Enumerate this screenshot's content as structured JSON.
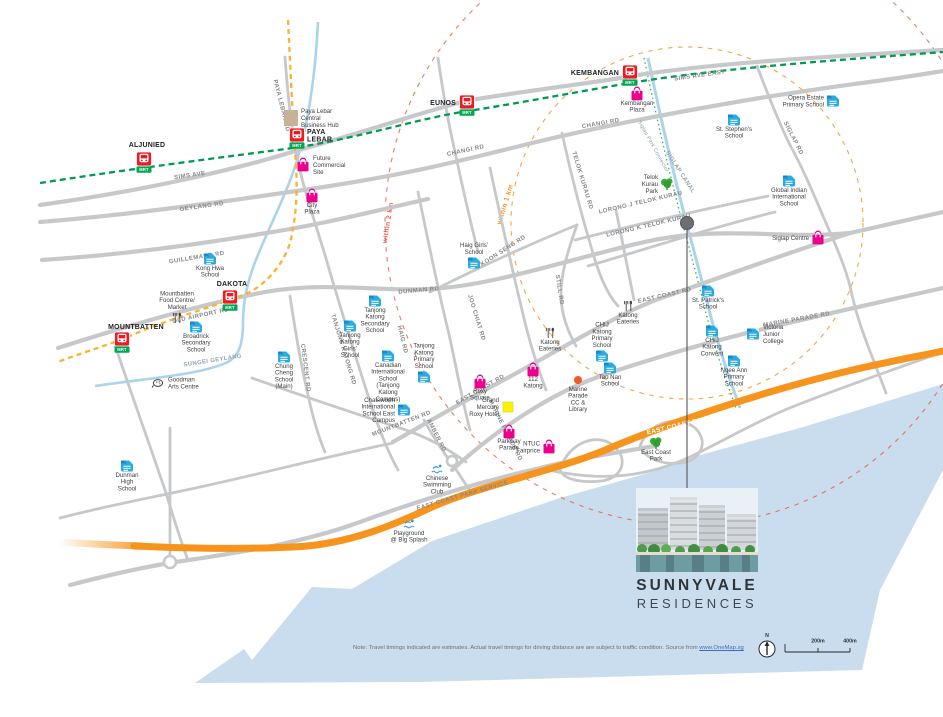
{
  "canvas": {
    "width": 943,
    "height": 717
  },
  "colors": {
    "sea": "#CADDEE",
    "road": "#C6C8CA",
    "ecp": "#F7941D",
    "mrt_line": "#009A55",
    "circle_line": "#F9B233",
    "ring1": "#F7941D",
    "ring2": "#E8604C",
    "school": "#29ABE2",
    "school_dark": "#1B86C8",
    "mall": "#EC008C",
    "park": "#3AAA35",
    "station_red": "#EC1C24",
    "station_green": "#00A651",
    "water": "#ABD4EC",
    "connector_green": "#39B54A",
    "eatery": "#414042",
    "swim": "#2D9CDB",
    "cc": "#F15A24",
    "hotel": "#FFF200",
    "hub": "#C7B299",
    "marker": "#6D6E71"
  },
  "marker": {
    "x": 687,
    "y": 223,
    "line_bottom": 489
  },
  "rings": [
    {
      "label": "within 1 km",
      "r": 176,
      "lx": 507,
      "ly": 205,
      "rot": -73,
      "color": "#F7941D"
    },
    {
      "label": "within 2 km",
      "r": 302,
      "lx": 390,
      "ly": 223,
      "rot": -81,
      "color": "#E8604C"
    }
  ],
  "stations": [
    {
      "name": "ALJUNIED",
      "lines": [
        "ALJUNIED"
      ],
      "x": 144,
      "y": 160,
      "lx": 3,
      "ly": -13,
      "anchor": "middle",
      "badge": "MRT"
    },
    {
      "name": "PAYA LEBAR",
      "lines": [
        "PAYA",
        "LEBAR"
      ],
      "x": 297,
      "y": 136,
      "lx": 10,
      "ly": -2,
      "anchor": "start",
      "badge": "MRT"
    },
    {
      "name": "EUNOS",
      "lines": [
        "EUNOS"
      ],
      "x": 467,
      "y": 103,
      "lx": -11,
      "ly": 2,
      "anchor": "end",
      "badge": "MRT"
    },
    {
      "name": "KEMBANGAN",
      "lines": [
        "KEMBANGAN"
      ],
      "x": 630,
      "y": 73,
      "lx": -11,
      "ly": 2,
      "anchor": "end",
      "badge": "MRT"
    },
    {
      "name": "DAKOTA",
      "lines": [
        "DAKOTA"
      ],
      "x": 230,
      "y": 298,
      "lx": 2,
      "ly": -12,
      "anchor": "middle",
      "badge": "MRT"
    },
    {
      "name": "MOUNTBATTEN",
      "lines": [
        "MOUNTBATTEN"
      ],
      "x": 122,
      "y": 340,
      "lx": 14,
      "ly": -11,
      "anchor": "middle",
      "badge": "MRT"
    }
  ],
  "road_labels": [
    {
      "t": "SIMS AVE",
      "x": 190,
      "y": 177,
      "r": -8
    },
    {
      "t": "SIMS AVE EAST",
      "x": 700,
      "y": 77,
      "r": -8
    },
    {
      "t": "GEYLANG RD",
      "x": 202,
      "y": 208,
      "r": -8
    },
    {
      "t": "CHANGI RD",
      "x": 466,
      "y": 152,
      "r": -12
    },
    {
      "t": "CHANGI RD",
      "x": 601,
      "y": 125,
      "r": -10
    },
    {
      "t": "GUILLEMARD RD",
      "x": 197,
      "y": 259,
      "r": -9
    },
    {
      "t": "PAYA LEBAR RD",
      "x": 280,
      "y": 106,
      "r": 76
    },
    {
      "t": "OLD AIRPORT RD",
      "x": 201,
      "y": 317,
      "r": -12
    },
    {
      "t": "DUNMAN RD",
      "x": 419,
      "y": 292,
      "r": -5
    },
    {
      "t": "KOON SENG RD",
      "x": 504,
      "y": 252,
      "r": -33
    },
    {
      "t": "JOO CHIAT RD",
      "x": 475,
      "y": 318,
      "r": 73
    },
    {
      "t": "HAIG RD",
      "x": 401,
      "y": 340,
      "r": 76
    },
    {
      "t": "CRESCENT RD",
      "x": 304,
      "y": 368,
      "r": 83
    },
    {
      "t": "TANJONG KATONG RD",
      "x": 342,
      "y": 350,
      "r": 73
    },
    {
      "t": "STILL RD",
      "x": 558,
      "y": 290,
      "r": 81
    },
    {
      "t": "TELOK KURAU RD",
      "x": 581,
      "y": 181,
      "r": 73
    },
    {
      "t": "LORONG J TELOK KURAU",
      "x": 641,
      "y": 204,
      "r": -13
    },
    {
      "t": "LORONG K TELOK KURAU",
      "x": 649,
      "y": 227,
      "r": -13
    },
    {
      "t": "EAST COAST RD",
      "x": 481,
      "y": 391,
      "r": -30
    },
    {
      "t": "EAST COAST RD",
      "x": 665,
      "y": 297,
      "r": -13
    },
    {
      "t": "MARINE PARADE RD",
      "x": 504,
      "y": 431,
      "r": 63
    },
    {
      "t": "MARINE PARADE RD",
      "x": 797,
      "y": 321,
      "r": -10
    },
    {
      "t": "MOUNTBATTEN RD",
      "x": 402,
      "y": 425,
      "r": -21
    },
    {
      "t": "AMBER RD",
      "x": 435,
      "y": 436,
      "r": 63
    },
    {
      "t": "SIGLAP RD",
      "x": 792,
      "y": 139,
      "r": 63
    },
    {
      "t": "EAST COAST PARK SERVICE",
      "x": 463,
      "y": 497,
      "r": -16
    }
  ],
  "water_labels": [
    {
      "t": "SUNGEI GEYLANG",
      "x": 213,
      "y": 362,
      "r": -9,
      "cls": "wl"
    },
    {
      "t": "SIGLAP CANAL",
      "x": 679,
      "y": 173,
      "r": 57,
      "cls": "wl"
    },
    {
      "t": "Siglap Park Connector",
      "x": 652,
      "y": 147,
      "r": 61,
      "cls": "wl2"
    }
  ],
  "ecp_label": {
    "t": "EAST COAST PARKWAY (ECP)",
    "x": 697,
    "y": 423,
    "r": -13
  },
  "pois": [
    {
      "label": [
        "Paya Lebar",
        "Central",
        "Business Hub"
      ],
      "type": "hub",
      "x": 291,
      "y": 118,
      "lp": "right"
    },
    {
      "label": [
        "Future",
        "Commercial",
        "Site"
      ],
      "type": "mall",
      "x": 303,
      "y": 165,
      "lp": "right"
    },
    {
      "label": [
        "City",
        "Plaza"
      ],
      "type": "mall",
      "x": 312,
      "y": 196,
      "lp": "below"
    },
    {
      "label": [
        "Kembangan",
        "Plaza"
      ],
      "type": "mall",
      "x": 637,
      "y": 94,
      "lp": "below"
    },
    {
      "label": [
        "Kong Hwa",
        "School"
      ],
      "type": "school",
      "x": 210,
      "y": 259,
      "lp": "below"
    },
    {
      "label": [
        "Mountbatten",
        "Food Centre/",
        "Market"
      ],
      "type": "eatery",
      "x": 177,
      "y": 318,
      "lp": "above"
    },
    {
      "label": [
        "Broadrick",
        "Secondary",
        "School"
      ],
      "type": "school",
      "x": 196,
      "y": 327,
      "lp": "below"
    },
    {
      "label": [
        "Goodman",
        "Arts Centre"
      ],
      "type": "arts",
      "x": 158,
      "y": 383,
      "lp": "right"
    },
    {
      "label": [
        "Dunman",
        "High",
        "School"
      ],
      "type": "school",
      "x": 127,
      "y": 466,
      "lp": "below"
    },
    {
      "label": [
        "Chung",
        "Cheng",
        "School",
        "(Main)"
      ],
      "type": "school",
      "x": 284,
      "y": 357,
      "lp": "below"
    },
    {
      "label": [
        "Tanjong",
        "Katong",
        "Secondary",
        "School"
      ],
      "type": "school",
      "x": 375,
      "y": 301,
      "lp": "below"
    },
    {
      "label": [
        "Tanjong",
        "Katong",
        "Girls'",
        "School"
      ],
      "type": "school",
      "x": 350,
      "y": 326,
      "lp": "below"
    },
    {
      "label": [
        "Canadian",
        "International",
        "School",
        "(Tanjong",
        "Katong",
        "Campus)"
      ],
      "type": "school",
      "x": 388,
      "y": 356,
      "lp": "below"
    },
    {
      "label": [
        "Tanjong",
        "Katong",
        "Primary",
        "School"
      ],
      "type": "school",
      "x": 424,
      "y": 377,
      "lp": "above"
    },
    {
      "label": [
        "Chatsworth",
        "International",
        "School East",
        "Campus"
      ],
      "type": "school",
      "x": 404,
      "y": 410,
      "lp": "left"
    },
    {
      "label": [
        "Haig Girls'",
        "School"
      ],
      "type": "school",
      "x": 474,
      "y": 263,
      "lp": "above"
    },
    {
      "label": [
        "112",
        "Katong"
      ],
      "type": "mall",
      "x": 533,
      "y": 370,
      "lp": "below"
    },
    {
      "label": [
        "Roxy",
        "Square"
      ],
      "type": "mall",
      "x": 480,
      "y": 382,
      "lp": "below"
    },
    {
      "label": [
        "Grand",
        "Mercure",
        "Roxy Hotel"
      ],
      "type": "hotel",
      "x": 508,
      "y": 407,
      "lp": "left"
    },
    {
      "label": [
        "Parkway",
        "Parade"
      ],
      "type": "mall",
      "x": 509,
      "y": 432,
      "lp": "below"
    },
    {
      "label": [
        "NTUC",
        "Fairprice"
      ],
      "type": "mall",
      "x": 549,
      "y": 447,
      "lp": "left"
    },
    {
      "label": [
        "Katong",
        "Eateries"
      ],
      "type": "eatery",
      "x": 550,
      "y": 333,
      "lp": "below"
    },
    {
      "label": [
        "Katong",
        "Eateries"
      ],
      "type": "eatery",
      "x": 628,
      "y": 306,
      "lp": "below"
    },
    {
      "label": [
        "CHIJ",
        "Katong",
        "Primary",
        "School"
      ],
      "type": "school",
      "x": 602,
      "y": 356,
      "lp": "above"
    },
    {
      "label": [
        "Tao Nan",
        "School"
      ],
      "type": "school",
      "x": 610,
      "y": 368,
      "lp": "below"
    },
    {
      "label": [
        "Marine",
        "Parade",
        "CC &",
        "Library"
      ],
      "type": "cc",
      "x": 578,
      "y": 380,
      "lp": "below"
    },
    {
      "label": [
        "St. Patrick's",
        "School"
      ],
      "type": "school",
      "x": 708,
      "y": 291,
      "lp": "below"
    },
    {
      "label": [
        "CHIJ",
        "Katong",
        "Convent"
      ],
      "type": "school",
      "x": 712,
      "y": 331,
      "lp": "below"
    },
    {
      "label": [
        "Victoria",
        "Junior",
        "College"
      ],
      "type": "school",
      "x": 753,
      "y": 334,
      "lp": "right"
    },
    {
      "label": [
        "Ngee Ann",
        "Primary",
        "School"
      ],
      "type": "school",
      "x": 734,
      "y": 361,
      "lp": "below"
    },
    {
      "label": [
        "St. Stephen's",
        "School"
      ],
      "type": "school",
      "x": 734,
      "y": 120,
      "lp": "below"
    },
    {
      "label": [
        "Opera Estate",
        "Primary School"
      ],
      "type": "school",
      "x": 833,
      "y": 101,
      "lp": "left"
    },
    {
      "label": [
        "Global Indian",
        "International",
        "School"
      ],
      "type": "school",
      "x": 789,
      "y": 181,
      "lp": "below"
    },
    {
      "label": [
        "Siglap Centre"
      ],
      "type": "mall",
      "x": 818,
      "y": 238,
      "lp": "left"
    },
    {
      "label": [
        "Telok",
        "Kurau",
        "Park"
      ],
      "type": "park",
      "x": 667,
      "y": 184,
      "lp": "left"
    },
    {
      "label": [
        "East Coast",
        "Park"
      ],
      "type": "park",
      "x": 656,
      "y": 443,
      "lp": "below"
    },
    {
      "label": [
        "Chinese",
        "Swimming",
        "Club"
      ],
      "type": "swim",
      "x": 437,
      "y": 469,
      "lp": "below"
    },
    {
      "label": [
        "Playground",
        "@ Big Splash"
      ],
      "type": "swim",
      "x": 409,
      "y": 524,
      "lp": "below"
    }
  ],
  "project": {
    "name1": "SUNNYVALE",
    "name2": "RESIDENCES"
  },
  "note": {
    "prefix": "Note: Travel timings indicated are estimates. Actual travel timings for driving distance are are subject to traffic condition. Source from ",
    "link": "www.OneMap.sg"
  },
  "scalebar": {
    "mid": "200m",
    "end": "400m"
  },
  "compass": {
    "label": "N"
  }
}
